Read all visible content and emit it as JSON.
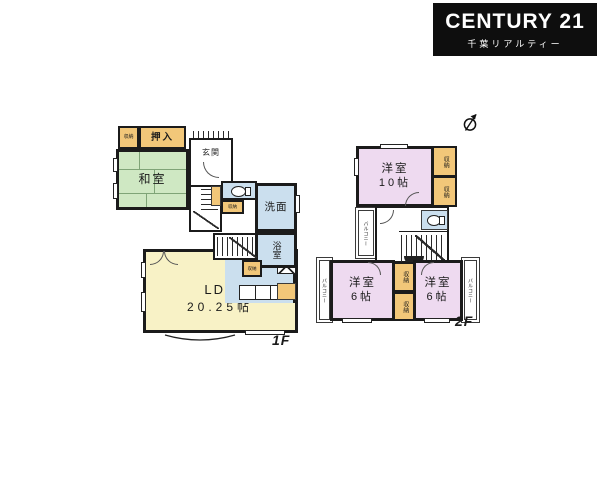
{
  "logo": {
    "brand": "CENTURY 21",
    "subtitle": "千葉リアルティー",
    "bg": "#0e0e0e",
    "fg": "#ffffff"
  },
  "icons": {
    "north_arrow": "compass-north-indicator",
    "toilet": "toilet-bowl-plan-symbol",
    "stove": "x-marked-stove-box"
  },
  "colors": {
    "tatami_green": "#cfe8c3",
    "ldk_yellow": "#f8f2c6",
    "wet_area_blue": "#cbdfee",
    "closet_orange": "#f2c779",
    "western_room_pink": "#eedaf0",
    "wall_black": "#1b1b1b"
  },
  "floor1": {
    "label": "1F",
    "rooms": {
      "washitsu": "和室",
      "oshiire": "押入",
      "storage": "収納",
      "genkan": "玄関",
      "senmen": "洗面",
      "yokushitsu": "浴室",
      "ldk_name": "LDK",
      "ldk_size": "20.25帖"
    }
  },
  "floor2": {
    "label": "2F",
    "rooms": {
      "room10_name": "洋室",
      "room10_size": "10帖",
      "room6_left_name": "洋室",
      "room6_left_size": "6帖",
      "room6_right_name": "洋室",
      "room6_right_size": "6帖",
      "storage": "収納",
      "balcony": "バルコニー"
    }
  }
}
